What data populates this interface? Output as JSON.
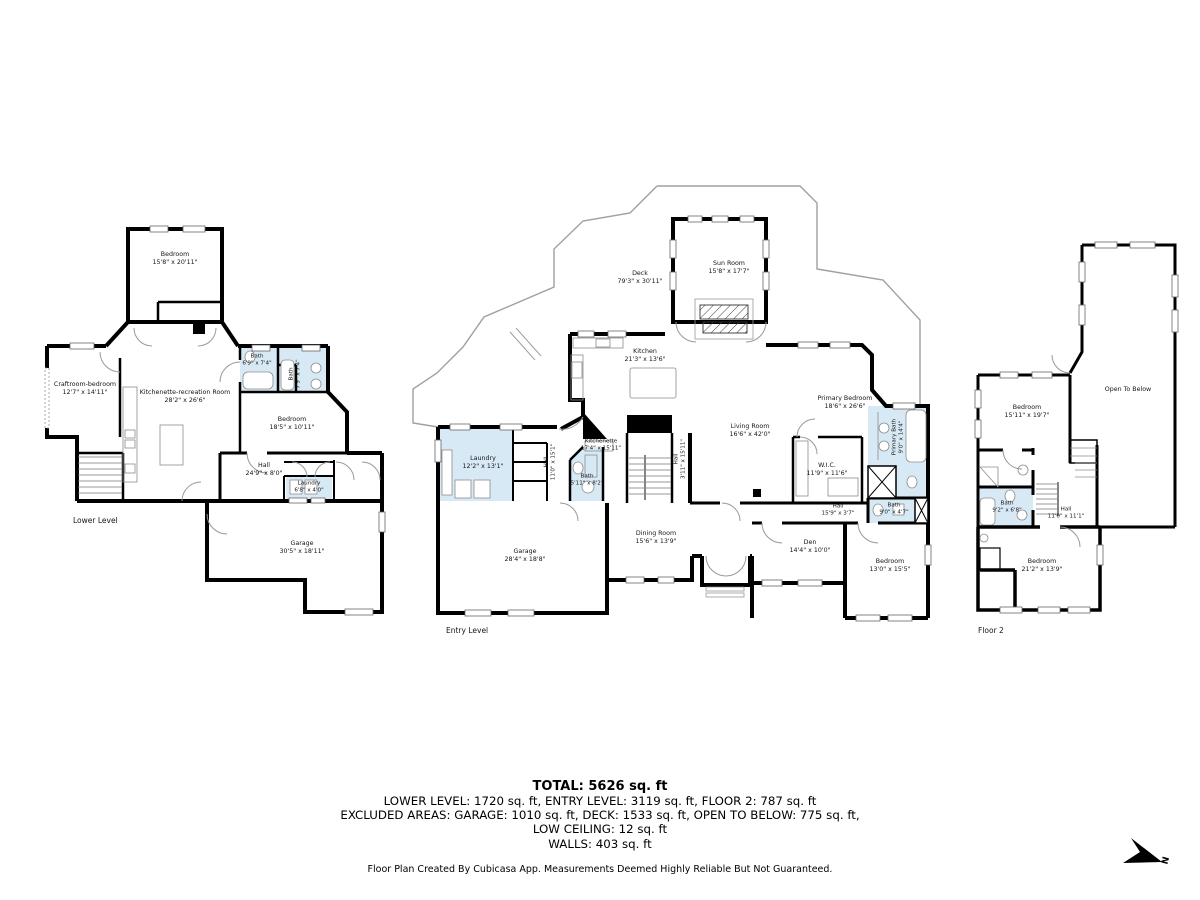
{
  "colors": {
    "wall": "#000000",
    "wet_room_fill": "#d8e9f6",
    "door_arc": "#999999",
    "deck_outline": "#a0a0a0"
  },
  "levels": [
    {
      "id": "lower",
      "label": "Lower Level",
      "label_pos": {
        "x": 73,
        "y": 516
      },
      "rooms": [
        {
          "name": "Bedroom",
          "dims": "15'8\" x 20'11\"",
          "x": 175,
          "y": 259
        },
        {
          "name": "Craftroom-bedroom",
          "dims": "12'7\" x 14'11\"",
          "x": 85,
          "y": 389
        },
        {
          "name": "Kitchenette-recreation Room",
          "dims": "28'2\" x 26'6\"",
          "x": 185,
          "y": 397
        },
        {
          "name": "Bath",
          "dims": "6'9\" x 7'4\"",
          "x": 257,
          "y": 361,
          "small": true
        },
        {
          "name": "Bath",
          "dims": "7'9\" x 7'4\"",
          "x": 296,
          "y": 374,
          "rotate": true,
          "small": true
        },
        {
          "name": "Bedroom",
          "dims": "18'5\" x 10'11\"",
          "x": 292,
          "y": 424
        },
        {
          "name": "Hall",
          "dims": "24'9\" x 8'0\"",
          "x": 264,
          "y": 470
        },
        {
          "name": "Laundry",
          "dims": "6'8\" x 4'0\"",
          "x": 309,
          "y": 488,
          "small": true
        },
        {
          "name": "Garage",
          "dims": "30'5\" x 18'11\"",
          "x": 302,
          "y": 548
        }
      ]
    },
    {
      "id": "entry",
      "label": "Entry Level",
      "label_pos": {
        "x": 446,
        "y": 626
      },
      "rooms": [
        {
          "name": "Deck",
          "dims": "79'3\" x 30'11\"",
          "x": 640,
          "y": 278
        },
        {
          "name": "Sun Room",
          "dims": "15'8\" x 17'7\"",
          "x": 729,
          "y": 268
        },
        {
          "name": "Kitchen",
          "dims": "21'3\" x 13'6\"",
          "x": 645,
          "y": 356
        },
        {
          "name": "Kitchenette",
          "dims": "17'4\" x 15'11\"",
          "x": 601,
          "y": 446,
          "small": true
        },
        {
          "name": "Bath",
          "dims": "5'11\" x 8'2\"",
          "x": 587,
          "y": 481,
          "small": true
        },
        {
          "name": "Hall",
          "dims": "11'0\" x 15'1\"",
          "x": 551,
          "y": 462,
          "rotate": true,
          "small": true
        },
        {
          "name": "Hall",
          "dims": "3'11\" x 15'11\"",
          "x": 681,
          "y": 459,
          "rotate": true,
          "small": true
        },
        {
          "name": "Laundry",
          "dims": "12'2\" x 13'1\"",
          "x": 483,
          "y": 463
        },
        {
          "name": "Living Room",
          "dims": "16'6\" x 42'0\"",
          "x": 750,
          "y": 431
        },
        {
          "name": "Primary Bedroom",
          "dims": "18'6\" x 26'6\"",
          "x": 845,
          "y": 403
        },
        {
          "name": "W.I.C.",
          "dims": "11'9\" x 11'6\"",
          "x": 827,
          "y": 470
        },
        {
          "name": "Primary Bath",
          "dims": "9'0\" x 14'4\"",
          "x": 899,
          "y": 437,
          "rotate": true,
          "small": true
        },
        {
          "name": "Hall",
          "dims": "15'9\" x 3'7\"",
          "x": 838,
          "y": 511,
          "small": true
        },
        {
          "name": "Bath",
          "dims": "9'0\" x 4'7\"",
          "x": 894,
          "y": 510,
          "small": true
        },
        {
          "name": "Den",
          "dims": "14'4\" x 10'0\"",
          "x": 810,
          "y": 547
        },
        {
          "name": "Bedroom",
          "dims": "13'0\" x 15'5\"",
          "x": 890,
          "y": 566
        },
        {
          "name": "Dining Room",
          "dims": "15'6\" x 13'9\"",
          "x": 656,
          "y": 538
        },
        {
          "name": "Garage",
          "dims": "28'4\" x 18'8\"",
          "x": 525,
          "y": 556
        }
      ]
    },
    {
      "id": "floor2",
      "label": "Floor 2",
      "label_pos": {
        "x": 978,
        "y": 626
      },
      "rooms": [
        {
          "name": "Open To Below",
          "dims": "",
          "x": 1128,
          "y": 390
        },
        {
          "name": "Bedroom",
          "dims": "15'11\" x 19'7\"",
          "x": 1027,
          "y": 412
        },
        {
          "name": "Bath",
          "dims": "9'2\" x 6'8\"",
          "x": 1007,
          "y": 508,
          "small": true
        },
        {
          "name": "Hall",
          "dims": "11'0\" x 11'1\"",
          "x": 1066,
          "y": 514,
          "small": true
        },
        {
          "name": "Bedroom",
          "dims": "21'2\" x 13'9\"",
          "x": 1042,
          "y": 566
        }
      ]
    }
  ],
  "footer": {
    "total": "TOTAL: 5626 sq. ft",
    "area_line": "LOWER LEVEL: 1720 sq. ft, ENTRY LEVEL: 3119 sq. ft, FLOOR 2: 787 sq. ft",
    "excluded_line": "EXCLUDED AREAS: GARAGE: 1010 sq. ft, DECK: 1533 sq. ft, OPEN TO BELOW: 775 sq. ft,",
    "low_ceiling_line": "LOW CEILING: 12 sq. ft",
    "walls_line": "WALLS: 403 sq. ft",
    "disclaimer": "Floor Plan Created By Cubicasa App. Measurements Deemed Highly Reliable But Not Guaranteed."
  },
  "compass": {
    "label": "N"
  }
}
